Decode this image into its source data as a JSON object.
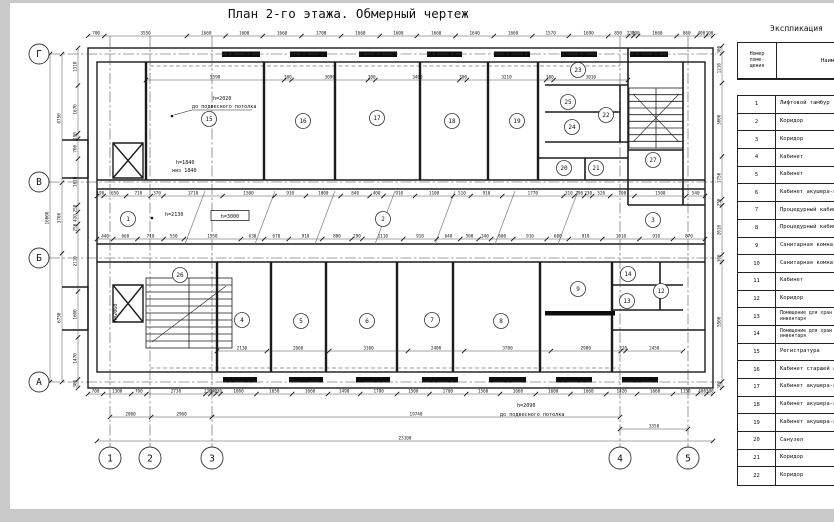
{
  "title": "План 2-го этажа. Обмерный чертеж",
  "colors": {
    "paper": "#ffffff",
    "margin_gray": "#c9c9c9",
    "line": "#1b1b1b",
    "window_fill": "#0d0d0d"
  },
  "table": {
    "title": "Экспликация",
    "headers": {
      "number": "Номер\nпоме-\nщения",
      "name": "Наименование"
    },
    "rows": [
      {
        "n": "1",
        "name": "Лифтовой тамбур"
      },
      {
        "n": "2",
        "name": "Коридор"
      },
      {
        "n": "3",
        "name": "Коридор"
      },
      {
        "n": "4",
        "name": "Кабинет"
      },
      {
        "n": "5",
        "name": "Кабинет"
      },
      {
        "n": "6",
        "name": "Кабинет акушера-ги"
      },
      {
        "n": "7",
        "name": "Процедурный кабине"
      },
      {
        "n": "8",
        "name": "Процедурный кабине"
      },
      {
        "n": "9",
        "name": "Санитарная комнат"
      },
      {
        "n": "10",
        "name": "Санитарная комнат"
      },
      {
        "n": "11",
        "name": "Кабинет"
      },
      {
        "n": "12",
        "name": "Коридор"
      },
      {
        "n": "13",
        "name": "Помещение для хран\nинвентаря"
      },
      {
        "n": "14",
        "name": "Помещение для хран\nинвентаря"
      },
      {
        "n": "15",
        "name": "Регистратура"
      },
      {
        "n": "16",
        "name": "Кабинет старшей ак"
      },
      {
        "n": "17",
        "name": "Кабинет акушера-ги"
      },
      {
        "n": "18",
        "name": "Кабинет акушера-ги"
      },
      {
        "n": "19",
        "name": "Кабинет акушера-ги"
      },
      {
        "n": "20",
        "name": "Санузел"
      },
      {
        "n": "21",
        "name": "Коридор"
      },
      {
        "n": "22",
        "name": "Коридор"
      }
    ]
  },
  "plan": {
    "axes_left": [
      {
        "label": "Г",
        "y": 54
      },
      {
        "label": "В",
        "y": 182
      },
      {
        "label": "Б",
        "y": 258
      },
      {
        "label": "А",
        "y": 382
      }
    ],
    "axes_bottom": [
      {
        "label": "1",
        "x": 110
      },
      {
        "label": "2",
        "x": 150
      },
      {
        "label": "3",
        "x": 212
      },
      {
        "label": "4",
        "x": 620
      },
      {
        "label": "5",
        "x": 688
      }
    ],
    "rooms": [
      {
        "n": "15",
        "x": 209,
        "y": 119
      },
      {
        "n": "16",
        "x": 303,
        "y": 121
      },
      {
        "n": "17",
        "x": 377,
        "y": 118
      },
      {
        "n": "18",
        "x": 452,
        "y": 121
      },
      {
        "n": "19",
        "x": 517,
        "y": 121
      },
      {
        "n": "23",
        "x": 578,
        "y": 70
      },
      {
        "n": "25",
        "x": 568,
        "y": 102
      },
      {
        "n": "22",
        "x": 606,
        "y": 115
      },
      {
        "n": "24",
        "x": 572,
        "y": 127
      },
      {
        "n": "20",
        "x": 564,
        "y": 168
      },
      {
        "n": "21",
        "x": 596,
        "y": 168
      },
      {
        "n": "27",
        "x": 653,
        "y": 160
      },
      {
        "n": "1",
        "x": 128,
        "y": 219
      },
      {
        "n": "2",
        "x": 383,
        "y": 219
      },
      {
        "n": "3",
        "x": 653,
        "y": 220
      },
      {
        "n": "26",
        "x": 180,
        "y": 275
      },
      {
        "n": "4",
        "x": 242,
        "y": 320
      },
      {
        "n": "5",
        "x": 301,
        "y": 321
      },
      {
        "n": "6",
        "x": 367,
        "y": 321
      },
      {
        "n": "7",
        "x": 432,
        "y": 320
      },
      {
        "n": "8",
        "x": 501,
        "y": 321
      },
      {
        "n": "9",
        "x": 578,
        "y": 289
      },
      {
        "n": "14",
        "x": 628,
        "y": 274
      },
      {
        "n": "12",
        "x": 661,
        "y": 291
      },
      {
        "n": "13",
        "x": 627,
        "y": 301
      }
    ],
    "h_chains": [
      {
        "y": 36,
        "x1": 88,
        "x2": 713,
        "values": [
          "700",
          "3550",
          "1660",
          "1600",
          "1660",
          "1700",
          "1660",
          "1600",
          "1660",
          "1640",
          "1660",
          "1570",
          "1690",
          "850",
          "230",
          "200",
          "1660",
          "860",
          "400",
          "300"
        ]
      },
      {
        "y": 80,
        "x1": 146,
        "x2": 628,
        "values": [
          "5590",
          "300",
          "3090",
          "300",
          "3400",
          "300",
          "3210",
          "300",
          "3010"
        ]
      },
      {
        "y": 196,
        "x1": 97,
        "x2": 705,
        "values": [
          "190",
          "650",
          "710",
          "370",
          "1710",
          "1500",
          "910",
          "1000",
          "840",
          "400",
          "910",
          "1100",
          "510",
          "910",
          "1770",
          "310",
          "290",
          "230",
          "520",
          "700",
          "1500",
          "540"
        ]
      },
      {
        "y": 239,
        "x1": 97,
        "x2": 705,
        "values": [
          "440",
          "660",
          "710",
          "550",
          "1550",
          "630",
          "670",
          "910",
          "800",
          "290",
          "1110",
          "910",
          "640",
          "500",
          "340",
          "600",
          "910",
          "600",
          "910",
          "1010",
          "910",
          "870"
        ]
      },
      {
        "y": 351,
        "x1": 217,
        "x2": 683,
        "values": [
          "2130",
          "2660",
          "3360",
          "2400",
          "3700",
          "2980",
          "210",
          "2450"
        ]
      },
      {
        "y": 394,
        "x1": 88,
        "x2": 713,
        "values": [
          "700",
          "1300",
          "700",
          "2730",
          "230",
          "240",
          "230",
          "1660",
          "1650",
          "1660",
          "1490",
          "1700",
          "1500",
          "1700",
          "1560",
          "1660",
          "1600",
          "1660",
          "1420",
          "1660",
          "1150",
          "400",
          "300"
        ]
      },
      {
        "y": 417,
        "x1": 110,
        "x2": 212,
        "values": [
          "2000",
          "2960"
        ]
      },
      {
        "y": 417,
        "x1": 212,
        "x2": 620,
        "values": [
          "19740"
        ]
      },
      {
        "y": 429,
        "x1": 620,
        "x2": 688,
        "values": [
          "3350"
        ]
      },
      {
        "y": 441,
        "x1": 97,
        "x2": 713,
        "values": [
          "23100"
        ]
      }
    ],
    "v_chains": [
      {
        "x": 50,
        "y1": 54,
        "y2": 382,
        "values": [
          "16000"
        ]
      },
      {
        "x": 62,
        "y1": 54,
        "y2": 382,
        "values": [
          "6750",
          "3700",
          "6750"
        ]
      },
      {
        "x": 78,
        "y1": 48,
        "y2": 388,
        "values": [
          "1310",
          "1670",
          "190",
          "700",
          "1610",
          "250",
          "420",
          "250",
          "2110",
          "1600",
          "1470",
          "300"
        ]
      },
      {
        "x": 722,
        "y1": 46,
        "y2": 262,
        "values": [
          "300",
          "1210",
          "3000",
          "1750",
          "250",
          "2010",
          "300"
        ]
      },
      {
        "x": 722,
        "y1": 262,
        "y2": 388,
        "values": [
          "5500",
          "300"
        ]
      }
    ],
    "notes": [
      {
        "t": "h=2020",
        "x": 213,
        "y": 100
      },
      {
        "t": "до подвесного потолка",
        "x": 192,
        "y": 108
      },
      {
        "t": "h=1840",
        "x": 176,
        "y": 164
      },
      {
        "t": "низ 1840",
        "x": 172,
        "y": 172
      },
      {
        "t": "h=2130",
        "x": 165,
        "y": 216
      },
      {
        "t": "h=3000",
        "x": 230,
        "y": 218,
        "boxed": 1
      },
      {
        "t": "h=2090",
        "x": 517,
        "y": 407
      },
      {
        "t": "до подвесного потолка",
        "x": 500,
        "y": 416
      },
      {
        "t": "h=2060",
        "x": 117,
        "y": 322,
        "rot": 1
      }
    ]
  }
}
